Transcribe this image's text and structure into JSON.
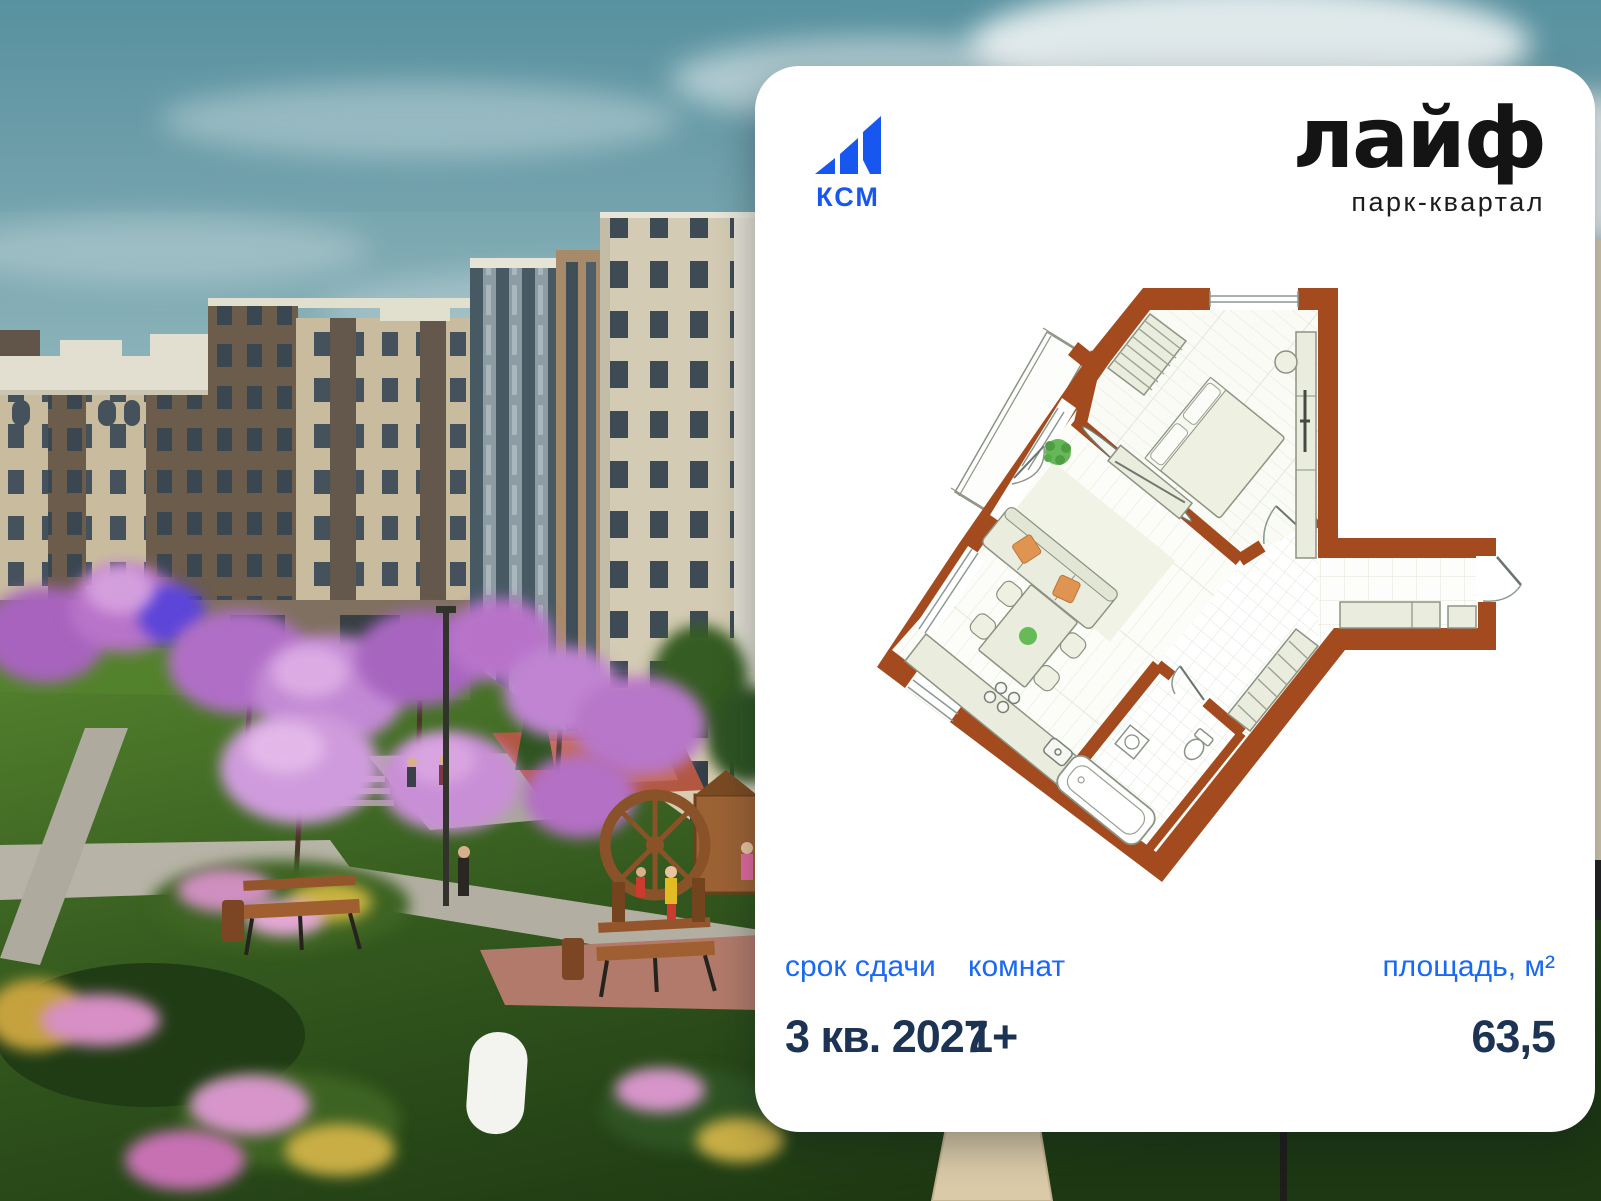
{
  "card": {
    "developer": {
      "name": "КСМ",
      "logo_icon": "ksm-ascending-bars-icon",
      "logo_color": "#1757f0"
    },
    "project": {
      "title": "лайф",
      "subtitle": "парк-квартал"
    },
    "stats": {
      "completion": {
        "label": "срок сдачи",
        "value": "3 кв. 2027"
      },
      "rooms": {
        "label": "комнат",
        "value": "1+"
      },
      "area": {
        "label": "площадь, м²",
        "value": "63,5"
      }
    }
  },
  "floor_plan": {
    "kind": "apartment-floor-plan",
    "wall_color": "#a34b1f",
    "furniture_color": "#eaedde",
    "accent_plant_color": "#66b757",
    "accent_pillow_color": "#df9452"
  },
  "background": {
    "description_colors": {
      "sky_top": "#58919f",
      "sky_bottom": "#c6d6d6",
      "lawn_dark": "#1d3812",
      "lawn_light": "#55842e",
      "blossom_purple": "#b873c9",
      "facade_beige": "#cdbb9a"
    }
  }
}
